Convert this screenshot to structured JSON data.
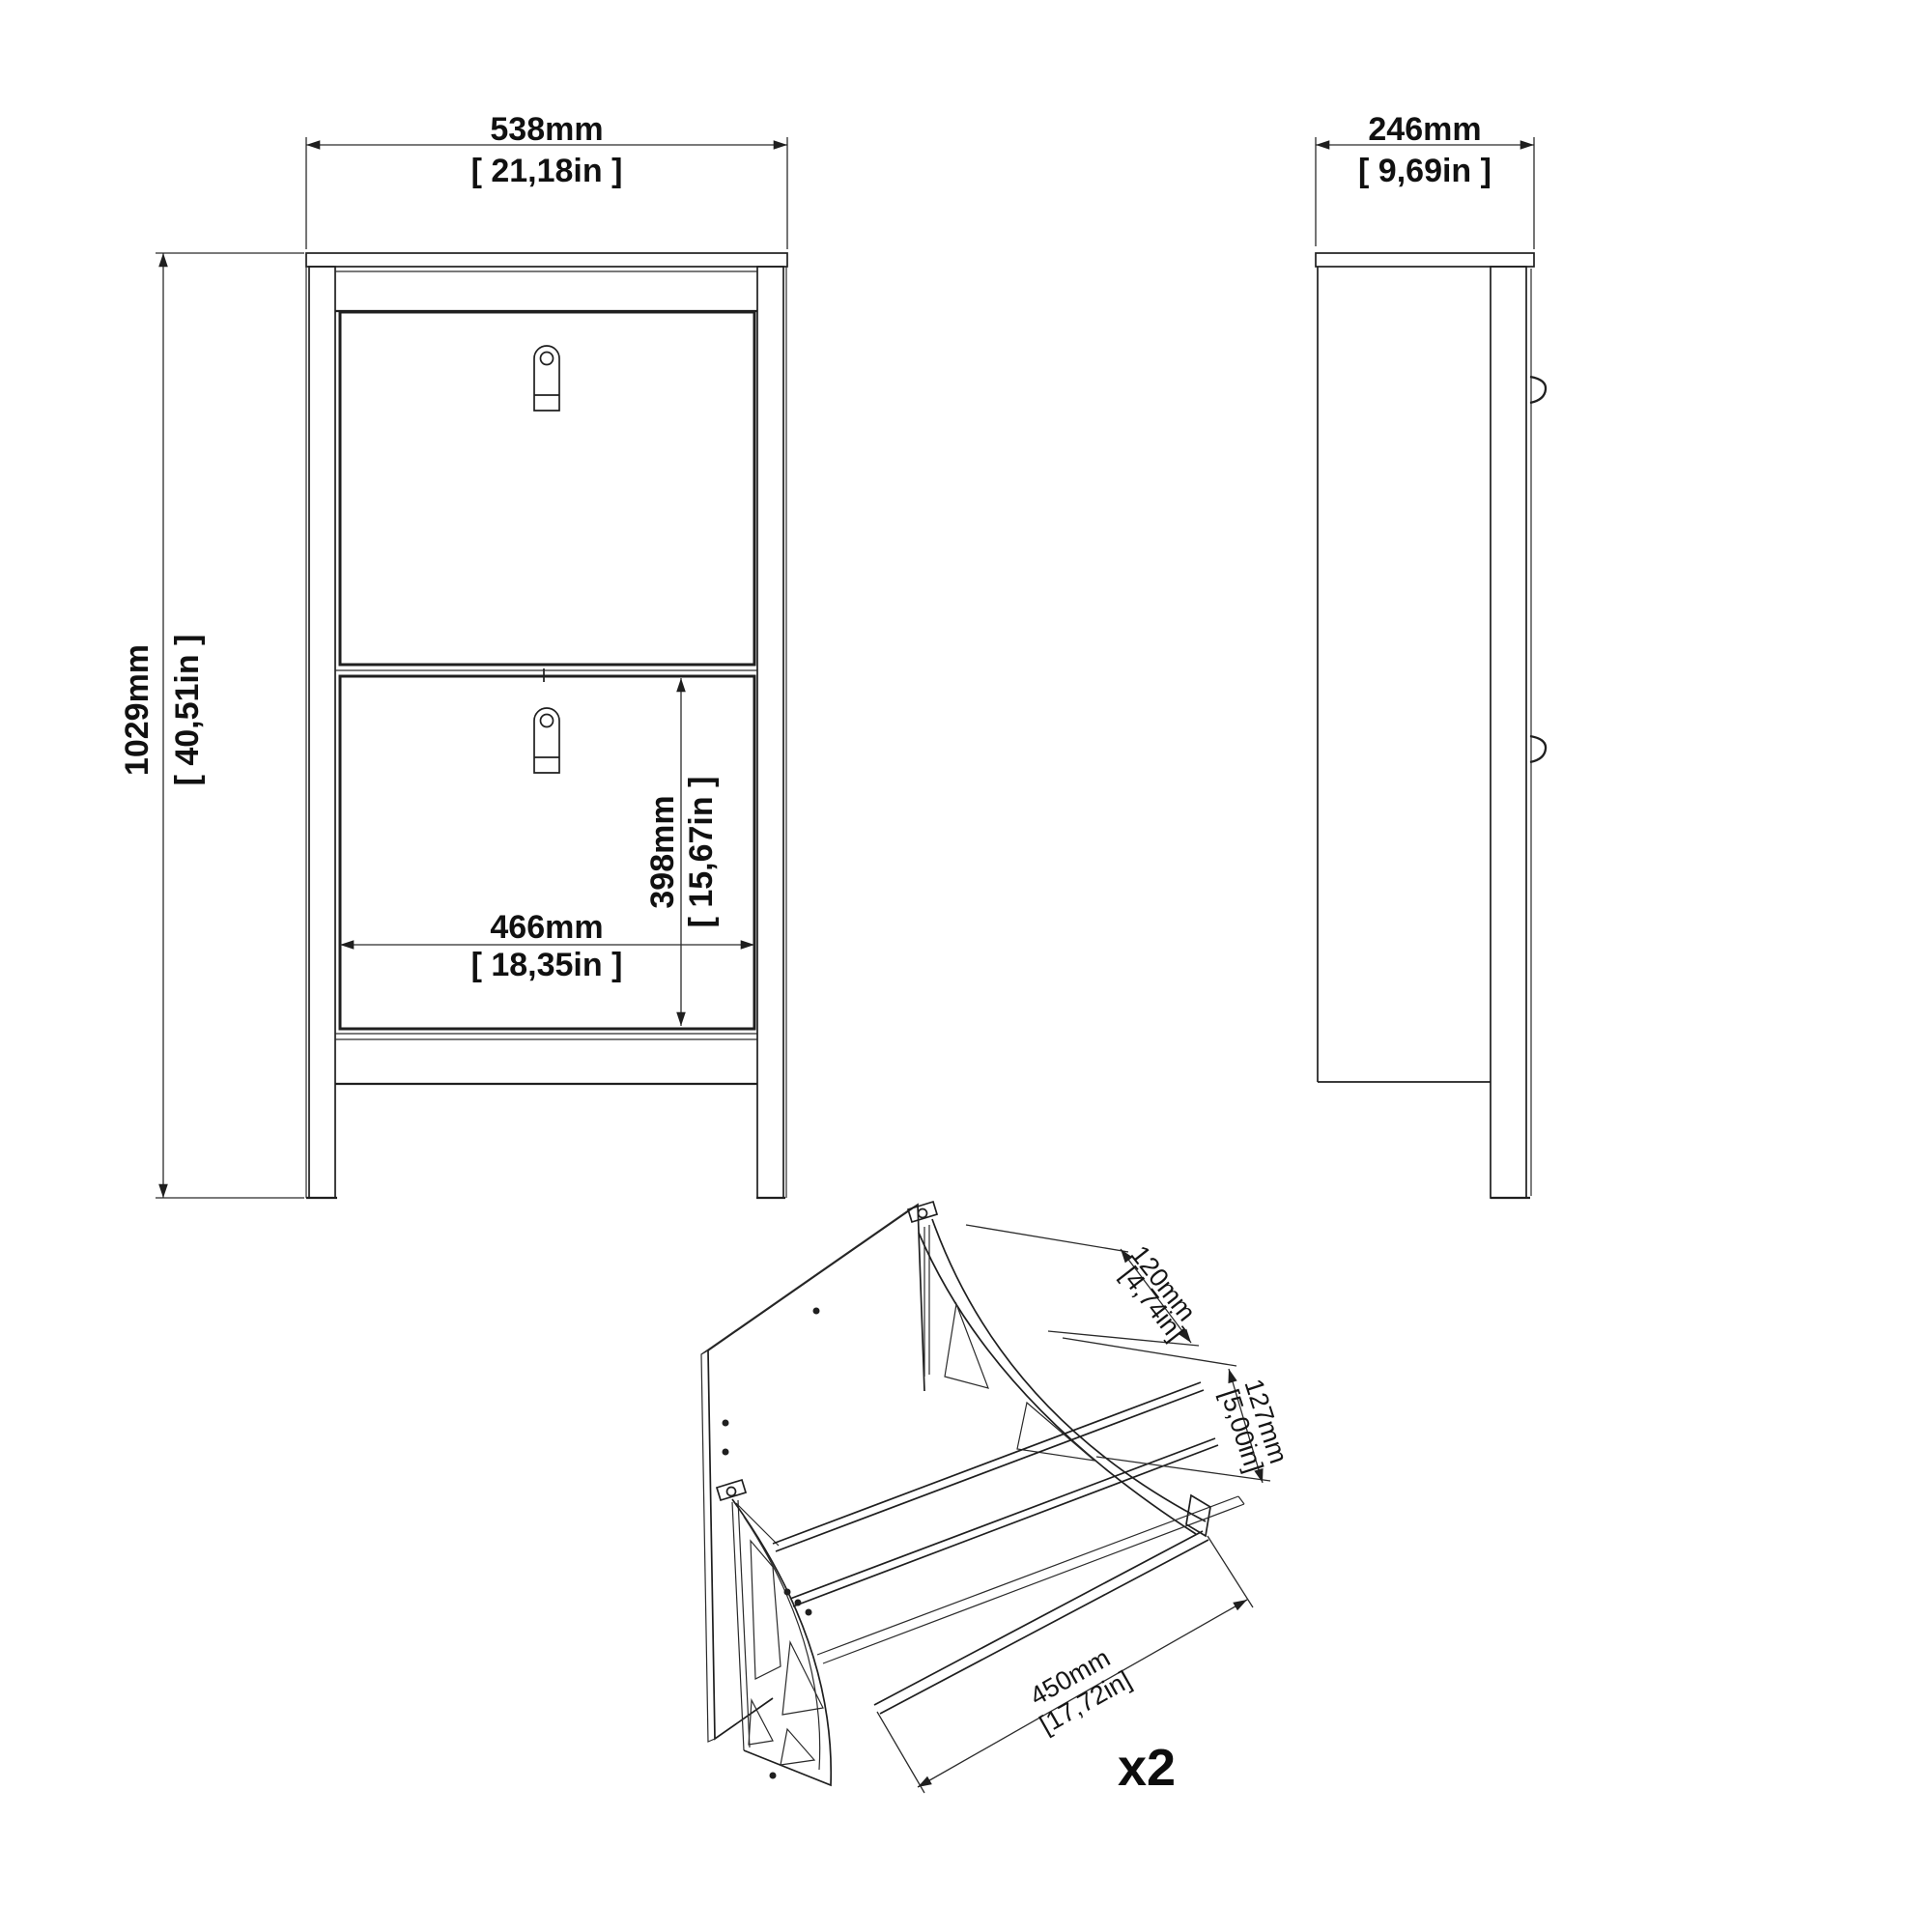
{
  "front_view": {
    "width": {
      "mm": "538mm",
      "inch": "[ 21,18in ]"
    },
    "height": {
      "mm": "1029mm",
      "inch": "[ 40,51in ]"
    },
    "inner_width": {
      "mm": "466mm",
      "inch": "[ 18,35in ]"
    },
    "inner_height": {
      "mm": "398mm",
      "inch": "[ 15,67in ]"
    }
  },
  "side_view": {
    "depth": {
      "mm": "246mm",
      "inch": "[ 9,69in ]"
    }
  },
  "detail_view": {
    "flap_depth": {
      "mm": "120mm",
      "inch": "[4,74in]"
    },
    "flap_height": {
      "mm": "127mm",
      "inch": "[5,00in]"
    },
    "flap_width": {
      "mm": "450mm",
      "inch": "[17,72in]"
    },
    "quantity": "x2"
  },
  "colors": {
    "line": "#1f1f1f",
    "background": "#ffffff"
  }
}
